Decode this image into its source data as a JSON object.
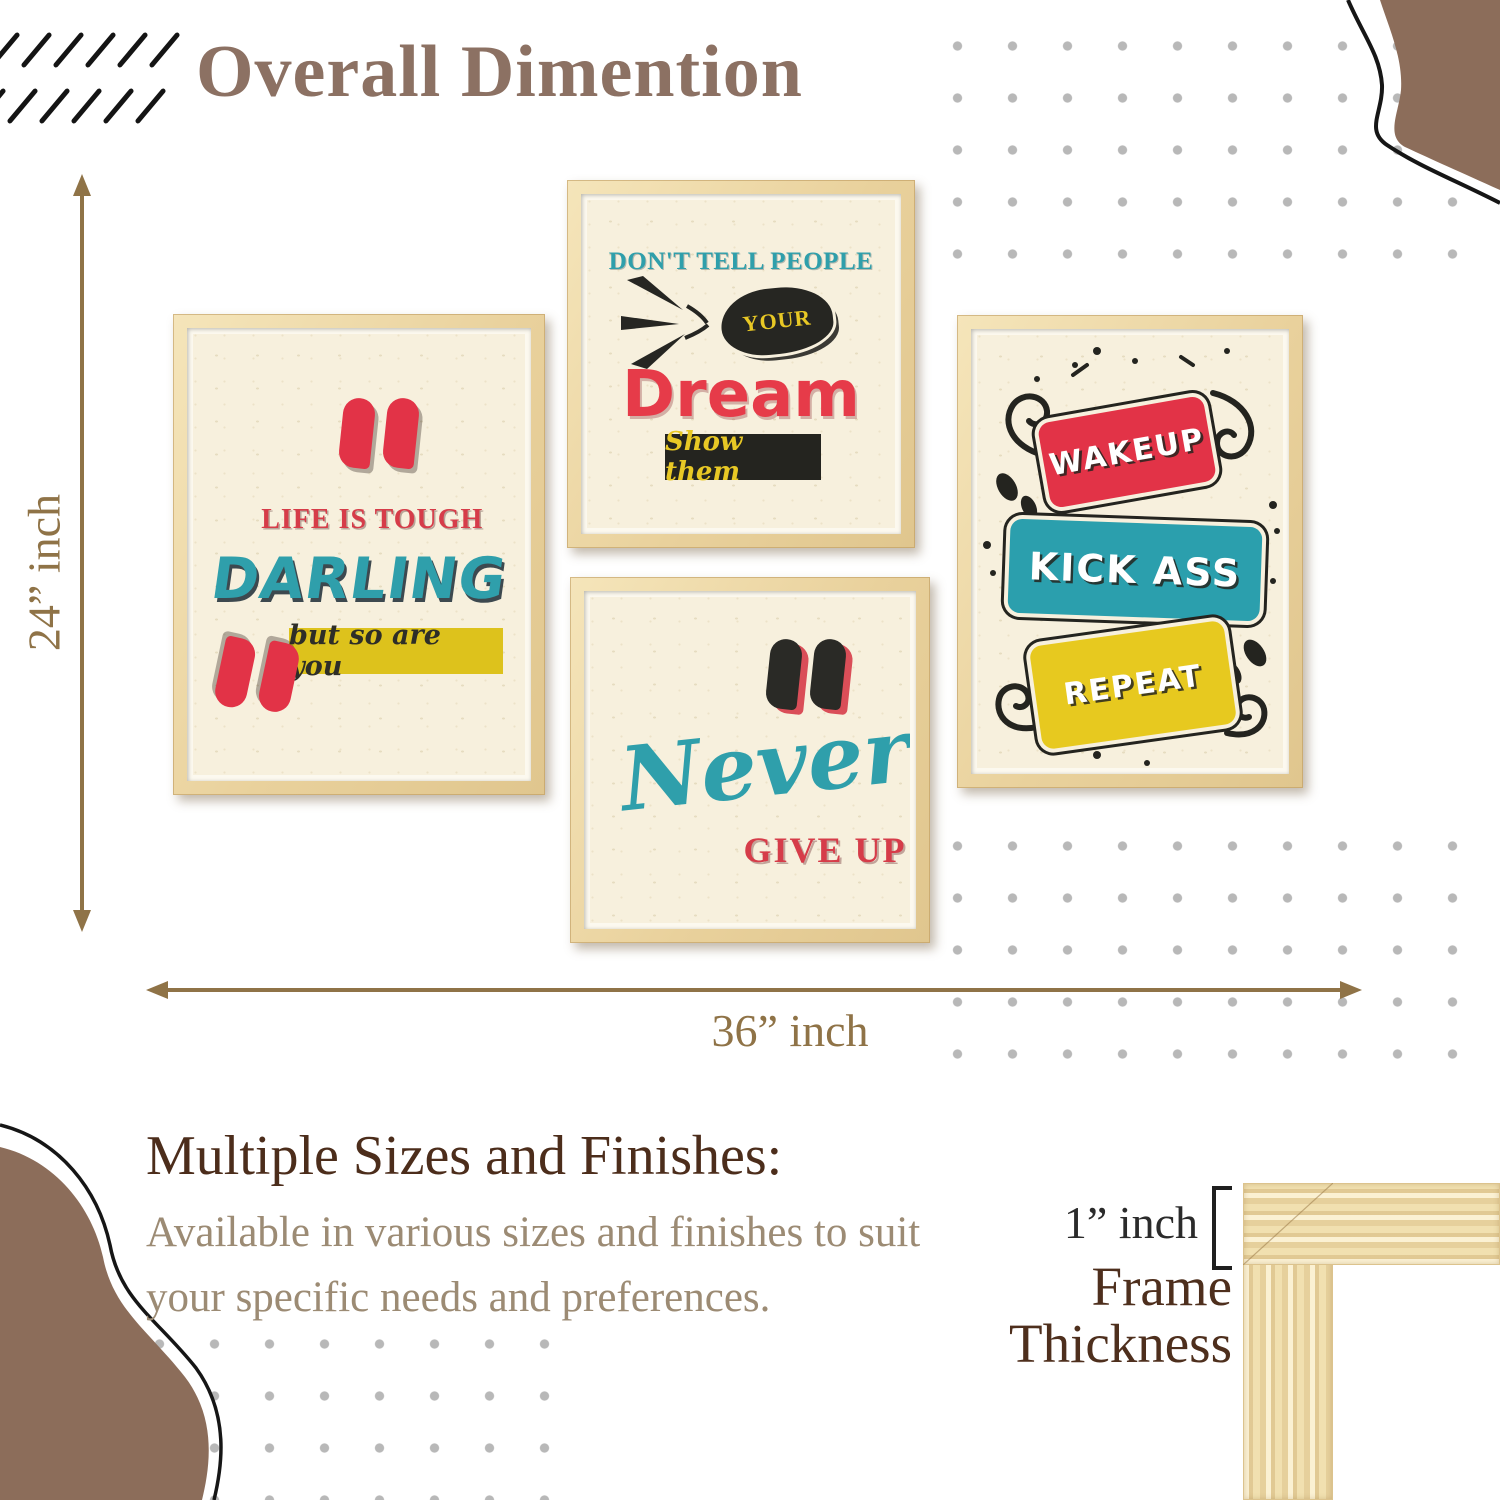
{
  "title": "Overall Dimention",
  "dimension": {
    "height": "24” inch",
    "width": "36” inch"
  },
  "frames": {
    "darling": {
      "line1": "LIFE IS TOUGH",
      "line2": "DARLING",
      "banner": "but so are you"
    },
    "dream": {
      "line1": "DON'T TELL PEOPLE",
      "badge": "YOUR",
      "line2": "Dream",
      "banner": "Show them"
    },
    "never": {
      "line1": "Never",
      "line2": "GIVE UP"
    },
    "repeat": {
      "card1": "WAKEUP",
      "card2": "KICK ASS",
      "card3": "REPEAT"
    }
  },
  "info": {
    "heading": "Multiple Sizes and Finishes:",
    "body1": "Available in various sizes and finishes to suit",
    "body2": "your specific needs and preferences.",
    "thickness_value": "1” inch",
    "thickness_line1": "Frame",
    "thickness_line2": "Thickness"
  },
  "icons": {
    "quote_close": "”",
    "quote_open": "“"
  },
  "colors": {
    "accent_red": "#e23347",
    "accent_teal": "#2b9fad",
    "accent_yellow": "#ddc21c",
    "title_brown": "#8c7163",
    "arrow_brown": "#8f7347",
    "heading_brown": "#4c2d1b",
    "body_tan": "#9c8b74",
    "blob_brown": "#8c6d5a",
    "wood_tan": "#eedcaa",
    "dot_gray": "#b8b8b8",
    "paper_cream": "#f7f0dd",
    "ink_black": "#24241f"
  }
}
